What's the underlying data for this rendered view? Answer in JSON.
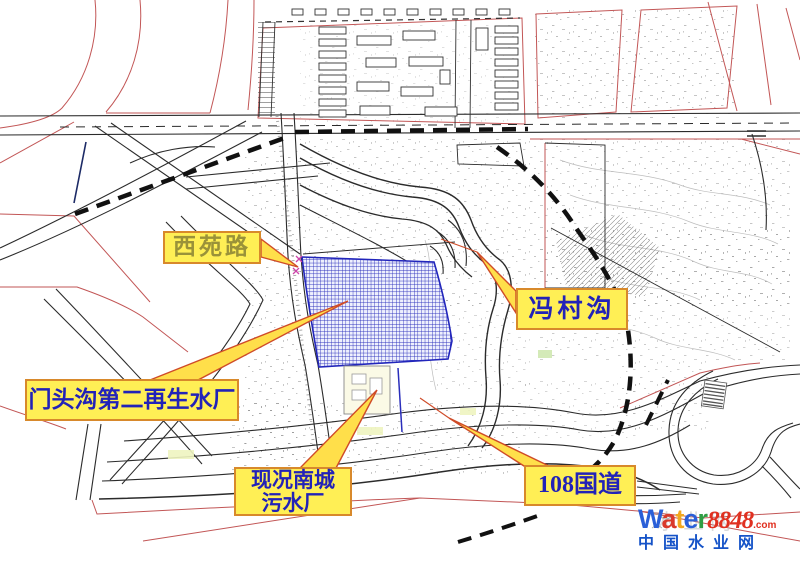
{
  "canvas": {
    "width": 800,
    "height": 567,
    "background": "#ffffff",
    "frame": "#cfcfcf"
  },
  "palette": {
    "callout_fill": "#ffef55",
    "callout_border": "#d8892b",
    "callout_text_blue": "#2222b8",
    "callout_text_olive": "#9a9239",
    "arrow_fill": "#ffdf4a",
    "arrow_stroke": "#cf4b28",
    "site_blue": "#2a2ebb",
    "line_black": "#2b2b2b",
    "line_red": "#c25656",
    "marker_magenta": "#cc44aa"
  },
  "callouts": [
    {
      "id": "xiyuan-road",
      "text": "西苑路"
    },
    {
      "id": "mentougou-plant",
      "text": "门头沟第二再生水厂"
    },
    {
      "id": "nancheng-plant",
      "text": "现况南城\n污水厂"
    },
    {
      "id": "fengcun-gou",
      "text": "冯村沟"
    },
    {
      "id": "g108",
      "text": "108国道"
    }
  ],
  "watermark": {
    "word": [
      {
        "ch": "W",
        "color": "#2a5fd8"
      },
      {
        "ch": "a",
        "color": "#d93a2b"
      },
      {
        "ch": "t",
        "color": "#f2a71f"
      },
      {
        "ch": "e",
        "color": "#2a5fd8"
      },
      {
        "ch": "r",
        "color": "#2f9e44"
      }
    ],
    "number": "8848",
    "number_color": "#e03020",
    "tld": ".com",
    "tld_color": "#e03020",
    "subtitle": "中国水业网",
    "subtitle_color": "#1553c8",
    "ghost": "水业网"
  }
}
